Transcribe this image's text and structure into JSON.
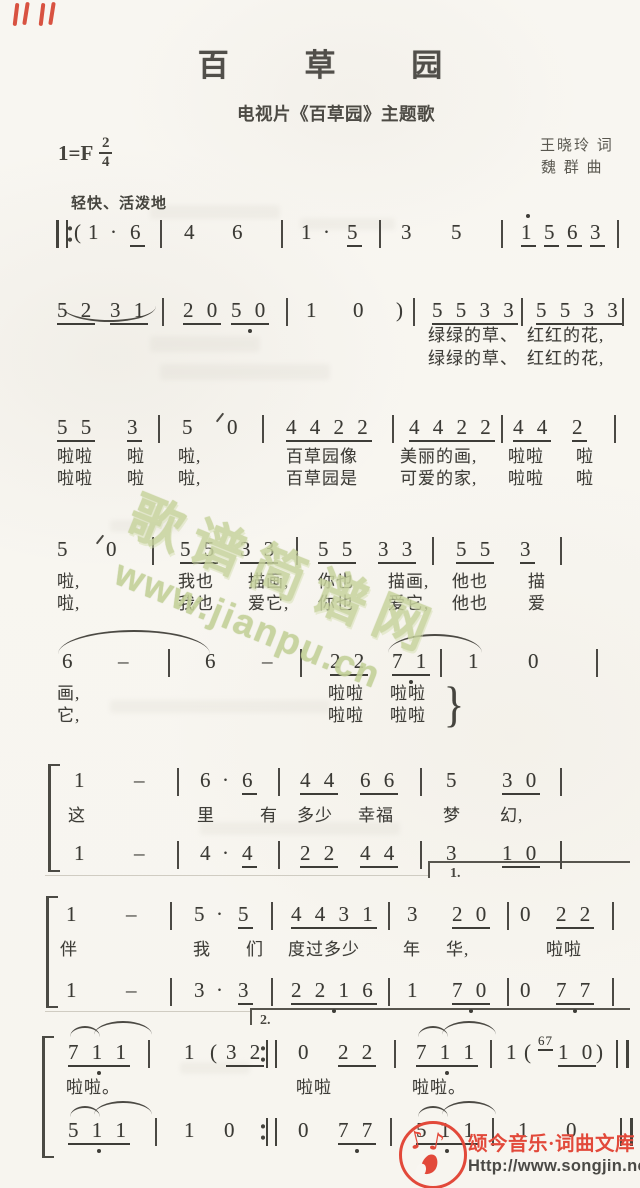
{
  "header": {
    "title": "百 草 园",
    "subtitle": "电视片《百草园》主题歌",
    "key": "1=F",
    "meter_num": "2",
    "meter_den": "4",
    "lyricist": "王晓玲 词",
    "composer": "魏 群 曲",
    "tempo": "轻快、活泼地"
  },
  "watermark": {
    "line1": "歌谱简谱网",
    "line2": "www.jianpu.cn",
    "color": "#c8d49e"
  },
  "footer": {
    "brand": "颂今音乐·词曲文库",
    "url": "Http://www.songjin.net",
    "accent": "#e2493a"
  },
  "music": {
    "voltas": {
      "first": "1.",
      "second": "2."
    },
    "lines": [
      {
        "name": "system-1",
        "y": 222,
        "tokens": [
          {
            "x": 56,
            "k": "repstart"
          },
          {
            "x": 74,
            "t": "("
          },
          {
            "x": 88,
            "t": "1"
          },
          {
            "x": 110,
            "t": "·"
          },
          {
            "x": 130,
            "t": "6",
            "u": 1
          },
          {
            "x": 160,
            "k": "bar"
          },
          {
            "x": 184,
            "t": "4"
          },
          {
            "x": 232,
            "t": "6"
          },
          {
            "x": 281,
            "k": "bar"
          },
          {
            "x": 301,
            "t": "1"
          },
          {
            "x": 323,
            "t": "·"
          },
          {
            "x": 347,
            "t": "5",
            "u": 1
          },
          {
            "x": 379,
            "k": "bar"
          },
          {
            "x": 401,
            "t": "3"
          },
          {
            "x": 451,
            "t": "5"
          },
          {
            "x": 501,
            "k": "bar"
          },
          {
            "x": 521,
            "t": "1",
            "u": 1,
            "hi": 1
          },
          {
            "x": 544,
            "t": "5",
            "u": 1
          },
          {
            "x": 567,
            "t": "6",
            "u": 1
          },
          {
            "x": 590,
            "t": "3",
            "u": 1
          },
          {
            "x": 617,
            "k": "bar"
          }
        ],
        "lyrics": []
      },
      {
        "name": "system-2",
        "y": 300,
        "tokens": [
          {
            "x": 57,
            "t": "5 2",
            "u": 1
          },
          {
            "x": 110,
            "t": "3 1",
            "u": 1
          },
          {
            "x": 162,
            "k": "bar"
          },
          {
            "x": 183,
            "t": "2 0",
            "u": 1
          },
          {
            "x": 231,
            "t": "5 0",
            "u": 1,
            "lo": 1
          },
          {
            "x": 286,
            "k": "bar"
          },
          {
            "x": 306,
            "t": "1"
          },
          {
            "x": 353,
            "t": "0"
          },
          {
            "x": 396,
            "t": ")"
          },
          {
            "x": 413,
            "k": "bar"
          },
          {
            "x": 432,
            "t": "5 5 3 3",
            "u": 1
          },
          {
            "x": 521,
            "k": "bar"
          },
          {
            "x": 536,
            "t": "5 5 3 3",
            "u": 1
          },
          {
            "x": 622,
            "k": "bar"
          }
        ],
        "lyrics": [
          {
            "x": 428,
            "y": 326,
            "t": "绿绿的草、"
          },
          {
            "x": 527,
            "y": 326,
            "t": "红红的花,"
          },
          {
            "x": 428,
            "y": 349,
            "t": "绿绿的草、"
          },
          {
            "x": 527,
            "y": 349,
            "t": "红红的花,"
          }
        ]
      },
      {
        "name": "system-3",
        "y": 417,
        "tokens": [
          {
            "x": 57,
            "t": "5 5",
            "u": 1
          },
          {
            "x": 127,
            "t": "3",
            "u": 1
          },
          {
            "x": 158,
            "k": "bar"
          },
          {
            "x": 182,
            "t": "5"
          },
          {
            "x": 227,
            "t": "0"
          },
          {
            "x": 262,
            "k": "bar"
          },
          {
            "x": 286,
            "t": "4 4 2 2",
            "u": 1
          },
          {
            "x": 392,
            "k": "bar"
          },
          {
            "x": 409,
            "t": "4 4 2 2",
            "u": 1
          },
          {
            "x": 501,
            "k": "bar"
          },
          {
            "x": 513,
            "t": "4 4",
            "u": 1
          },
          {
            "x": 572,
            "t": "2",
            "u": 1
          },
          {
            "x": 614,
            "k": "bar"
          }
        ],
        "lyrics": [
          {
            "x": 57,
            "y": 447,
            "t": "啦啦"
          },
          {
            "x": 127,
            "y": 447,
            "t": "啦"
          },
          {
            "x": 178,
            "y": 447,
            "t": "啦,"
          },
          {
            "x": 286,
            "y": 447,
            "t": "百草园像"
          },
          {
            "x": 400,
            "y": 447,
            "t": "美丽的画,"
          },
          {
            "x": 508,
            "y": 447,
            "t": "啦啦"
          },
          {
            "x": 576,
            "y": 447,
            "t": "啦"
          },
          {
            "x": 57,
            "y": 469,
            "t": "啦啦"
          },
          {
            "x": 127,
            "y": 469,
            "t": "啦"
          },
          {
            "x": 178,
            "y": 469,
            "t": "啦,"
          },
          {
            "x": 286,
            "y": 469,
            "t": "百草园是"
          },
          {
            "x": 400,
            "y": 469,
            "t": "可爱的家,"
          },
          {
            "x": 508,
            "y": 469,
            "t": "啦啦"
          },
          {
            "x": 576,
            "y": 469,
            "t": "啦"
          }
        ]
      },
      {
        "name": "system-4",
        "y": 539,
        "tokens": [
          {
            "x": 57,
            "t": "5"
          },
          {
            "x": 106,
            "t": "0"
          },
          {
            "x": 152,
            "k": "bar"
          },
          {
            "x": 180,
            "t": "5 5",
            "u": 1
          },
          {
            "x": 240,
            "t": "3 3",
            "u": 1
          },
          {
            "x": 296,
            "k": "bar"
          },
          {
            "x": 318,
            "t": "5 5",
            "u": 1
          },
          {
            "x": 378,
            "t": "3 3",
            "u": 1
          },
          {
            "x": 432,
            "k": "bar"
          },
          {
            "x": 456,
            "t": "5 5",
            "u": 1
          },
          {
            "x": 520,
            "t": "3",
            "u": 1
          },
          {
            "x": 560,
            "k": "bar"
          }
        ],
        "lyrics": [
          {
            "x": 57,
            "y": 572,
            "t": "啦,"
          },
          {
            "x": 178,
            "y": 572,
            "t": "我也"
          },
          {
            "x": 248,
            "y": 572,
            "t": "描画,"
          },
          {
            "x": 318,
            "y": 572,
            "t": "你也"
          },
          {
            "x": 388,
            "y": 572,
            "t": "描画,"
          },
          {
            "x": 452,
            "y": 572,
            "t": "他也"
          },
          {
            "x": 528,
            "y": 572,
            "t": "描"
          },
          {
            "x": 57,
            "y": 594,
            "t": "啦,"
          },
          {
            "x": 178,
            "y": 594,
            "t": "我也"
          },
          {
            "x": 248,
            "y": 594,
            "t": "爱它,"
          },
          {
            "x": 318,
            "y": 594,
            "t": "你也"
          },
          {
            "x": 388,
            "y": 594,
            "t": "爱它,"
          },
          {
            "x": 452,
            "y": 594,
            "t": "他也"
          },
          {
            "x": 528,
            "y": 594,
            "t": "爱"
          }
        ]
      },
      {
        "name": "system-5",
        "y": 651,
        "tokens": [
          {
            "x": 62,
            "t": "6"
          },
          {
            "x": 118,
            "t": "–"
          },
          {
            "x": 168,
            "k": "bar"
          },
          {
            "x": 205,
            "t": "6"
          },
          {
            "x": 262,
            "t": "–"
          },
          {
            "x": 300,
            "k": "bar"
          },
          {
            "x": 330,
            "t": "2 2",
            "u": 1
          },
          {
            "x": 392,
            "t": "7 1",
            "u": 1,
            "lo": 1
          },
          {
            "x": 440,
            "k": "bar"
          },
          {
            "x": 468,
            "t": "1"
          },
          {
            "x": 528,
            "t": "0"
          },
          {
            "x": 596,
            "k": "bar"
          },
          {
            "x": 442,
            "t": "}",
            "cls": "brace",
            "dy": 28
          }
        ],
        "lyrics": [
          {
            "x": 57,
            "y": 684,
            "t": "画,"
          },
          {
            "x": 328,
            "y": 684,
            "t": "啦啦"
          },
          {
            "x": 390,
            "y": 684,
            "t": "啦啦"
          },
          {
            "x": 57,
            "y": 706,
            "t": "它,"
          },
          {
            "x": 328,
            "y": 706,
            "t": "啦啦"
          },
          {
            "x": 390,
            "y": 706,
            "t": "啦啦"
          }
        ]
      },
      {
        "name": "system-6-voice-1",
        "y": 770,
        "tokens": [
          {
            "x": 74,
            "t": "1"
          },
          {
            "x": 134,
            "t": "–"
          },
          {
            "x": 177,
            "k": "bar"
          },
          {
            "x": 200,
            "t": "6"
          },
          {
            "x": 222,
            "t": "·"
          },
          {
            "x": 242,
            "t": "6",
            "u": 1
          },
          {
            "x": 278,
            "k": "bar"
          },
          {
            "x": 300,
            "t": "4 4",
            "u": 1
          },
          {
            "x": 360,
            "t": "6 6",
            "u": 1
          },
          {
            "x": 420,
            "k": "bar"
          },
          {
            "x": 446,
            "t": "5"
          },
          {
            "x": 502,
            "t": "3 0",
            "u": 1
          },
          {
            "x": 560,
            "k": "bar"
          }
        ],
        "lyrics": [
          {
            "x": 68,
            "y": 806,
            "t": "这"
          },
          {
            "x": 197,
            "y": 806,
            "t": "里"
          },
          {
            "x": 260,
            "y": 806,
            "t": "有"
          },
          {
            "x": 297,
            "y": 806,
            "t": "多少"
          },
          {
            "x": 358,
            "y": 806,
            "t": "幸福"
          },
          {
            "x": 443,
            "y": 806,
            "t": "梦"
          },
          {
            "x": 500,
            "y": 806,
            "t": "幻,"
          }
        ]
      },
      {
        "name": "system-6-voice-2",
        "y": 843,
        "tokens": [
          {
            "x": 74,
            "t": "1"
          },
          {
            "x": 134,
            "t": "–"
          },
          {
            "x": 177,
            "k": "bar"
          },
          {
            "x": 200,
            "t": "4"
          },
          {
            "x": 222,
            "t": "·"
          },
          {
            "x": 242,
            "t": "4",
            "u": 1
          },
          {
            "x": 278,
            "k": "bar"
          },
          {
            "x": 300,
            "t": "2 2",
            "u": 1
          },
          {
            "x": 360,
            "t": "4 4",
            "u": 1
          },
          {
            "x": 420,
            "k": "bar"
          },
          {
            "x": 446,
            "t": "3"
          },
          {
            "x": 502,
            "t": "1 0",
            "u": 1
          },
          {
            "x": 560,
            "k": "bar"
          }
        ],
        "lyrics": []
      },
      {
        "name": "system-7-voice-1",
        "y": 904,
        "tokens": [
          {
            "x": 66,
            "t": "1"
          },
          {
            "x": 126,
            "t": "–"
          },
          {
            "x": 170,
            "k": "bar"
          },
          {
            "x": 194,
            "t": "5"
          },
          {
            "x": 216,
            "t": "·"
          },
          {
            "x": 238,
            "t": "5",
            "u": 1
          },
          {
            "x": 271,
            "k": "bar"
          },
          {
            "x": 291,
            "t": "4 4 3 1",
            "u": 1
          },
          {
            "x": 388,
            "k": "bar"
          },
          {
            "x": 407,
            "t": "3"
          },
          {
            "x": 452,
            "t": "2 0",
            "u": 1
          },
          {
            "x": 507,
            "k": "bar"
          },
          {
            "x": 520,
            "t": "0"
          },
          {
            "x": 556,
            "t": "2 2",
            "u": 1
          },
          {
            "x": 612,
            "k": "bar"
          }
        ],
        "lyrics": [
          {
            "x": 60,
            "y": 940,
            "t": "伴"
          },
          {
            "x": 193,
            "y": 940,
            "t": "我"
          },
          {
            "x": 246,
            "y": 940,
            "t": "们"
          },
          {
            "x": 288,
            "y": 940,
            "t": "度过多少"
          },
          {
            "x": 403,
            "y": 940,
            "t": "年"
          },
          {
            "x": 446,
            "y": 940,
            "t": "华,"
          },
          {
            "x": 546,
            "y": 940,
            "t": "啦啦"
          }
        ]
      },
      {
        "name": "system-7-voice-2",
        "y": 980,
        "tokens": [
          {
            "x": 66,
            "t": "1"
          },
          {
            "x": 126,
            "t": "–"
          },
          {
            "x": 170,
            "k": "bar"
          },
          {
            "x": 194,
            "t": "3"
          },
          {
            "x": 216,
            "t": "·"
          },
          {
            "x": 238,
            "t": "3",
            "u": 1
          },
          {
            "x": 271,
            "k": "bar"
          },
          {
            "x": 291,
            "t": "2 2 1 6",
            "u": 1,
            "lo": 1
          },
          {
            "x": 388,
            "k": "bar"
          },
          {
            "x": 407,
            "t": "1"
          },
          {
            "x": 452,
            "t": "7 0",
            "u": 1,
            "lo": 1
          },
          {
            "x": 507,
            "k": "bar"
          },
          {
            "x": 520,
            "t": "0"
          },
          {
            "x": 556,
            "t": "7 7",
            "u": 1,
            "lo": 1
          },
          {
            "x": 612,
            "k": "bar"
          }
        ],
        "lyrics": []
      },
      {
        "name": "system-8-voice-1",
        "y": 1042,
        "tokens": [
          {
            "x": 68,
            "t": "7 1 1",
            "u": 1,
            "lo": 1
          },
          {
            "x": 148,
            "k": "bar"
          },
          {
            "x": 184,
            "t": "1"
          },
          {
            "x": 210,
            "t": "("
          },
          {
            "x": 226,
            "t": "3 2",
            "u": 1
          },
          {
            "x": 266,
            "k": "repend"
          },
          {
            "x": 298,
            "t": "0"
          },
          {
            "x": 338,
            "t": "2 2",
            "u": 1
          },
          {
            "x": 394,
            "k": "bar"
          },
          {
            "x": 416,
            "t": "7 1 1",
            "u": 1,
            "lo": 1
          },
          {
            "x": 490,
            "k": "bar"
          },
          {
            "x": 506,
            "t": "1"
          },
          {
            "x": 524,
            "t": "("
          },
          {
            "x": 538,
            "t": "67",
            "u": 1,
            "cls": "tiny",
            "dy": -8
          },
          {
            "x": 558,
            "t": "1 0",
            "u": 1
          },
          {
            "x": 596,
            "t": ")"
          },
          {
            "x": 616,
            "k": "final"
          }
        ],
        "lyrics": [
          {
            "x": 66,
            "y": 1078,
            "t": "啦啦。"
          },
          {
            "x": 296,
            "y": 1078,
            "t": "啦啦"
          },
          {
            "x": 412,
            "y": 1078,
            "t": "啦啦。"
          }
        ]
      },
      {
        "name": "system-8-voice-2",
        "y": 1120,
        "tokens": [
          {
            "x": 68,
            "t": "5 1 1",
            "u": 1,
            "lo": 1
          },
          {
            "x": 155,
            "k": "bar"
          },
          {
            "x": 184,
            "t": "1"
          },
          {
            "x": 224,
            "t": "0"
          },
          {
            "x": 266,
            "k": "repend"
          },
          {
            "x": 298,
            "t": "0"
          },
          {
            "x": 338,
            "t": "7 7",
            "u": 1,
            "lo": 1
          },
          {
            "x": 390,
            "k": "bar"
          },
          {
            "x": 416,
            "t": "5 1 1",
            "u": 1,
            "lo": 1
          },
          {
            "x": 492,
            "k": "bar"
          },
          {
            "x": 518,
            "t": "1"
          },
          {
            "x": 566,
            "t": "0"
          },
          {
            "x": 620,
            "k": "final"
          }
        ],
        "lyrics": []
      }
    ]
  }
}
